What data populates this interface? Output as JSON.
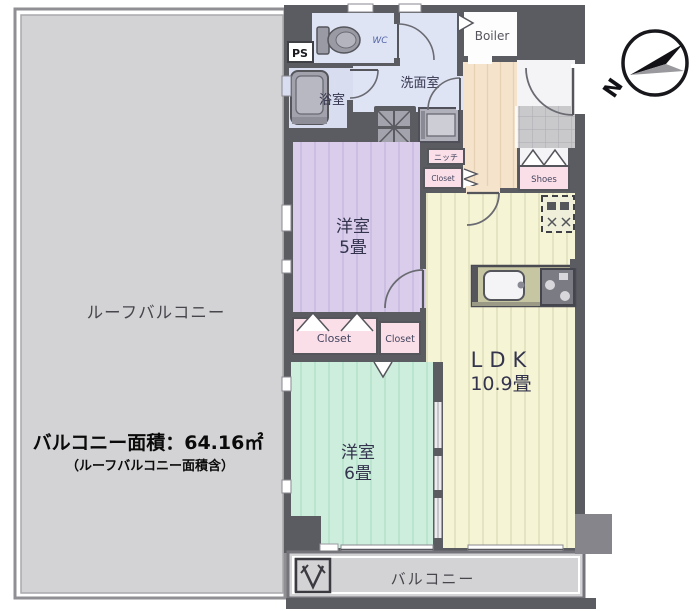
{
  "colors": {
    "wall": "#5b5b62",
    "roof_balcony_fill": "#d3d3d5",
    "balcony_fill": "#d3d3d5",
    "room5_fill": "#d9cdeb",
    "room5_stripe": "#c7b7de",
    "room6_fill": "#cdeedd",
    "room6_stripe": "#b2e1c8",
    "ldk_fill": "#f5f4d4",
    "ldk_stripe": "#dcdcba",
    "hall_fill": "#f5e3cc",
    "hall_stripe": "#e7d1b4",
    "wet_fill": "#dfe4f4",
    "bath_fill": "#d8def0",
    "tile_fill": "#c9c9cc",
    "tile_line": "#b1b1b5",
    "pink_fill": "#fadfe8",
    "counter_fill": "#c6c6a2"
  },
  "roof_balcony": {
    "label": "ルーフバルコニー",
    "area_line1": "バルコニー面積：64.16㎡",
    "area_line2": "（ルーフバルコニー面積含）"
  },
  "balcony": {
    "label": "バルコニー"
  },
  "compass": {
    "north": "N"
  },
  "rooms": {
    "room5": {
      "name": "洋室",
      "size": "5畳"
    },
    "room6": {
      "name": "洋室",
      "size": "6畳"
    },
    "ldk": {
      "name": "LDK",
      "size": "10.9畳"
    },
    "washroom": {
      "label": "洗面室"
    },
    "bath": {
      "label": "浴室"
    },
    "toilet": {
      "label": "WC"
    },
    "boiler": {
      "label": "Boiler"
    },
    "ps": {
      "label": "PS"
    },
    "niche": {
      "label": "ニッチ"
    },
    "closet_hall": {
      "label": "Closet"
    },
    "closet_room5": {
      "label": "Closet"
    },
    "closet_room6": {
      "label": "Closet"
    },
    "shoes": {
      "label": "Shoes"
    }
  }
}
